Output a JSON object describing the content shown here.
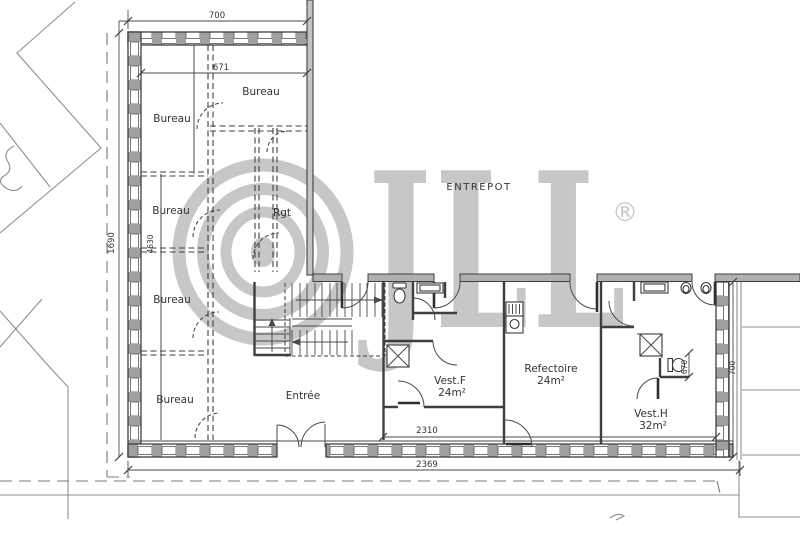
{
  "rooms": {
    "bureau_top_left": "Bureau",
    "bureau_top_center": "Bureau",
    "bureau_middle": "Bureau",
    "bureau_lower_middle": "Bureau",
    "bureau_bottom": "Bureau",
    "rgt": "Rgt",
    "entree": "Entrée",
    "entrepot": "ENTREPOT",
    "vest_f": {
      "name": "Vest.F",
      "area": "24m²"
    },
    "refectoire": {
      "name": "Refectoire",
      "area": "24m²"
    },
    "vest_h": {
      "name": "Vest.H",
      "area": "32m²"
    }
  },
  "dimensions": {
    "top_width": "700",
    "top_inner_width": "671",
    "left_height": "1690",
    "left_inner_height": "4630",
    "strip_inner_width": "2310",
    "overall_width": "2369",
    "wc_width": "670",
    "right_height": "700"
  },
  "watermark": {
    "brand": "JLL",
    "registered": "®"
  }
}
